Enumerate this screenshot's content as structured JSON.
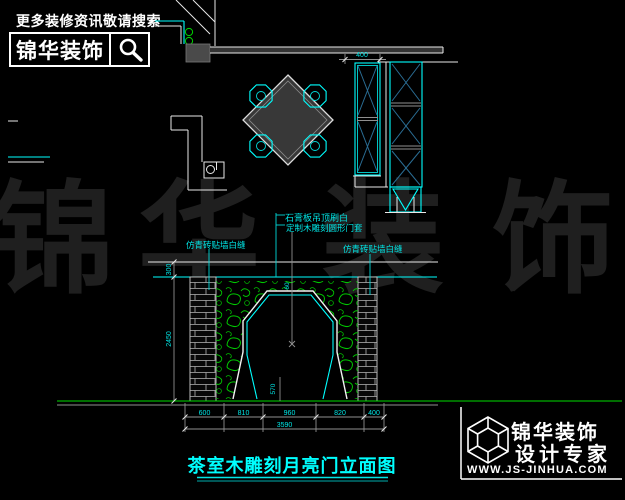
{
  "header": {
    "slogan": "更多装修资讯敬请搜索",
    "brand": "锦华装饰"
  },
  "watermark": {
    "chars": [
      "锦",
      "华",
      "装",
      "饰"
    ]
  },
  "icons": {
    "search": "magnifier-icon",
    "footer_logo": "isometric-cube-logo-icon"
  },
  "colors": {
    "background": "#000000",
    "cad_cyan": "#00ffff",
    "cad_green": "#00dc00",
    "foliage_green": "#00c800",
    "cad_white": "#eeeeee",
    "watermark_gray": "#1f1f1f",
    "brace_blue": "#2a6d94"
  },
  "plan": {
    "cabinet_depth_dim": "400"
  },
  "elevation": {
    "annotations": {
      "ceiling": "石膏板吊顶刷白",
      "door_frame": "定制木雕刻圆形门套",
      "brick_left": "仿青砖贴墙白缝",
      "brick_right": "仿青砖贴墙白缝"
    },
    "dims": {
      "ceiling_drop": "300",
      "height": "2450",
      "trim": "60",
      "foot": "570",
      "segments": [
        "600",
        "810",
        "960",
        "820",
        "400"
      ],
      "total": "3590"
    }
  },
  "title": "茶室木雕刻月亮门立面图",
  "footer": {
    "brand": "锦华装饰",
    "tagline": "设计专家",
    "website": "WWW.JS-JINHUA.COM"
  }
}
